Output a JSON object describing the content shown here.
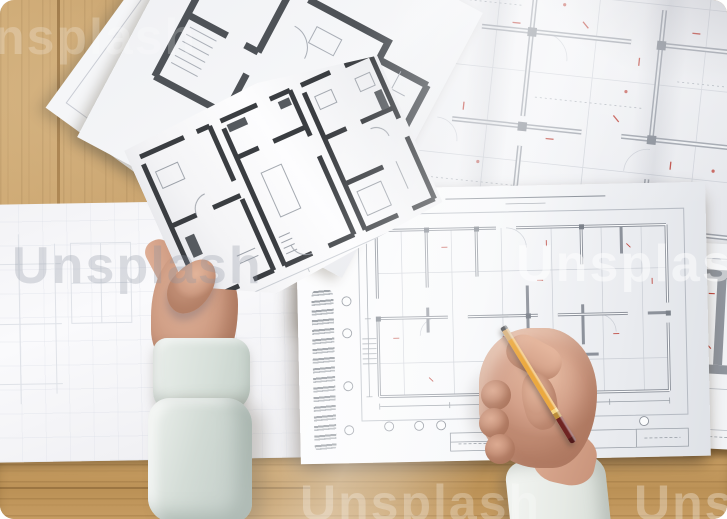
{
  "scene": {
    "aria_label": "Top-down photograph of an architect's desk: left hand holding a printed apartment floor plan, right hand holding a yellow pencil over a spiral-bound album with a drafted floor plan, surrounded by blueprint sheets on a wooden table",
    "objects": [
      {
        "name": "wooden-desk",
        "color": "#c59e66"
      },
      {
        "name": "blueprint-sheet-top-right",
        "desc": "unfolded floor plan with grey walls and red revision marks"
      },
      {
        "name": "faint-plan-sheet",
        "desc": "light technical drawing sheet with hatched details"
      },
      {
        "name": "bold-plan-sheet",
        "desc": "floor plan printed with thick dark walls"
      },
      {
        "name": "held-floor-plan-sheet",
        "desc": "three-unit apartment floor plan held up by the left hand"
      },
      {
        "name": "left-big-sheet",
        "desc": "mostly blank drawing sheet with faint grid lines"
      },
      {
        "name": "spiral-notebook",
        "desc": "spiral-bound album with floor plan, grid bubbles and title block"
      },
      {
        "name": "right-edge-sheet",
        "desc": "partial sheet with structural beam detail"
      },
      {
        "name": "left-hand",
        "desc": "thumb pressing the held sheet"
      },
      {
        "name": "right-hand",
        "desc": "fist gripping a pencil above the notebook plan"
      },
      {
        "name": "pencil",
        "color": "#eba940"
      },
      {
        "name": "left-sleeve",
        "color": "#d5ded8"
      },
      {
        "name": "right-cuff",
        "color": "#eef1ee"
      }
    ]
  },
  "watermark": {
    "text": "Unsplash"
  },
  "palette": {
    "wood": "#c59e66",
    "wood_shadow": "#9c7643",
    "paper": "#f4f5f7",
    "wall_dark": "#3f4246",
    "wall_grey": "#8f949c",
    "line_faint": "#c6cad2",
    "red_accent": "#bf4a42",
    "skin": "#d4a28b",
    "sleeve": "#d5ded8",
    "pencil_body": "#eba940",
    "pencil_end": "#6d2321"
  }
}
